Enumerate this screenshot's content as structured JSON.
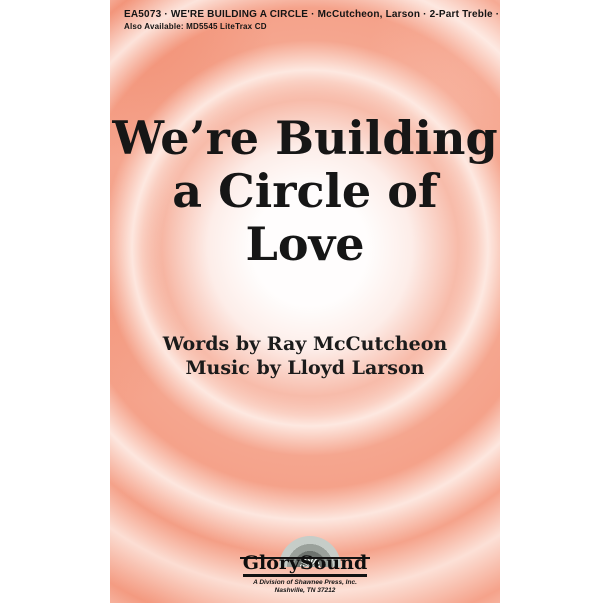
{
  "header": {
    "catalog_line": "EA5073 · WE'RE BUILDING A CIRCLE · McCutcheon, Larson · 2-Part Treble ·  $1.75",
    "availability_line": "Also Available: MD5545 LiteTrax CD"
  },
  "title": {
    "line1": "We’re Building",
    "line2": "a Circle of",
    "line3": "Love"
  },
  "credits": {
    "words": "Words by Ray McCutcheon",
    "music": "Music by Lloyd Larson"
  },
  "publisher": {
    "name": "GlorySound",
    "division": "A Division of Shawnee Press, Inc.",
    "address": "Nashville, TN 37212"
  },
  "colors": {
    "bg-base": "#f5a68f",
    "bg-deep": "#ef8061",
    "bg-glow": "#ffffff",
    "ink": "#141414",
    "sun-outer": "#c6cdc8",
    "sun-mid": "#9aa19b",
    "sun-inner": "#6e746f",
    "sun-spoke-dark": "#575e58",
    "sun-spoke-light": "#eaedea"
  }
}
